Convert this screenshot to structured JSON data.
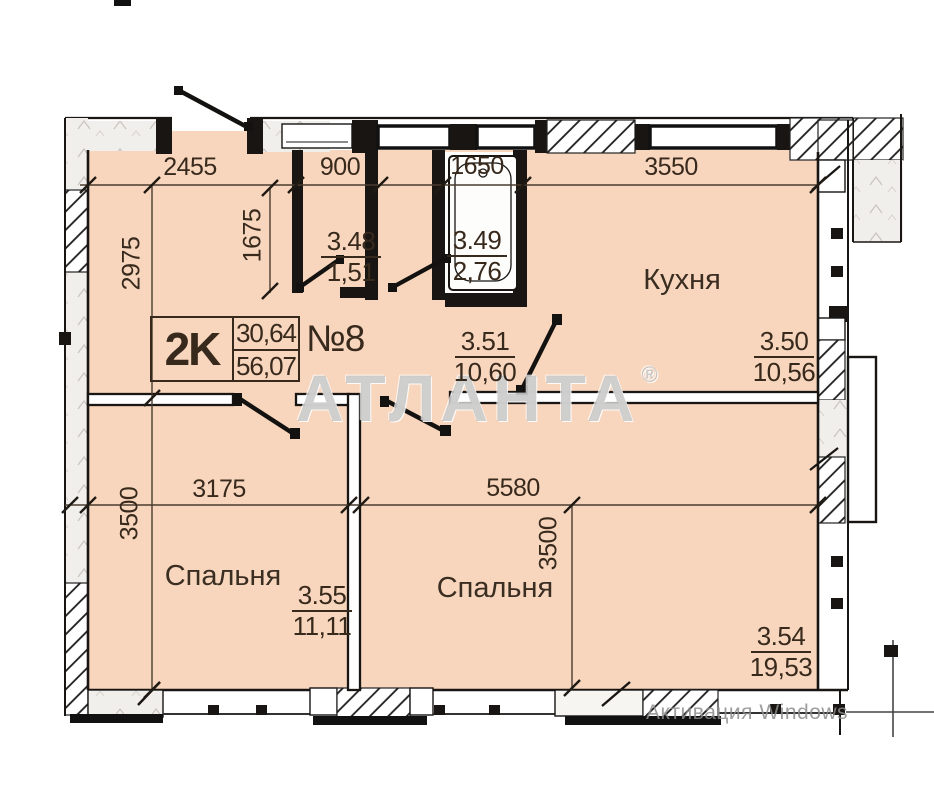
{
  "title_block": {
    "apartment_type": "2K",
    "area_top": "30,64",
    "area_total": "56,07",
    "unit_number": "№8"
  },
  "rooms": {
    "wc": {
      "num": "3.48",
      "area": "1,51"
    },
    "bath": {
      "num": "3.49",
      "area": "2,76"
    },
    "kitchen": {
      "num": "3.50",
      "area": "10,56",
      "label": "Кухня"
    },
    "hall": {
      "num": "3.51",
      "area": "10,60"
    },
    "bedroom1": {
      "num": "3.55",
      "area": "11,11",
      "label": "Спальня"
    },
    "bedroom2": {
      "num": "3.54",
      "area": "19,53",
      "label": "Спальня"
    }
  },
  "dimensions": {
    "top1": "2455",
    "top2": "900",
    "top3": "1650",
    "top4": "3550",
    "left_upper": "2975",
    "wc_height": "1675",
    "left_lower": "3500",
    "mid_left": "3175",
    "mid_right": "5580",
    "mid_vertical": "3500"
  },
  "watermark": {
    "brand": "АТЛАНТА",
    "reg": "®"
  },
  "overlay": {
    "activation": "Активация Windows"
  },
  "colors": {
    "room_fill": "#f8d6bd",
    "wall": "#181512",
    "dim_line": "#4a3c30",
    "watermark_gray": "#b2b2b2"
  }
}
